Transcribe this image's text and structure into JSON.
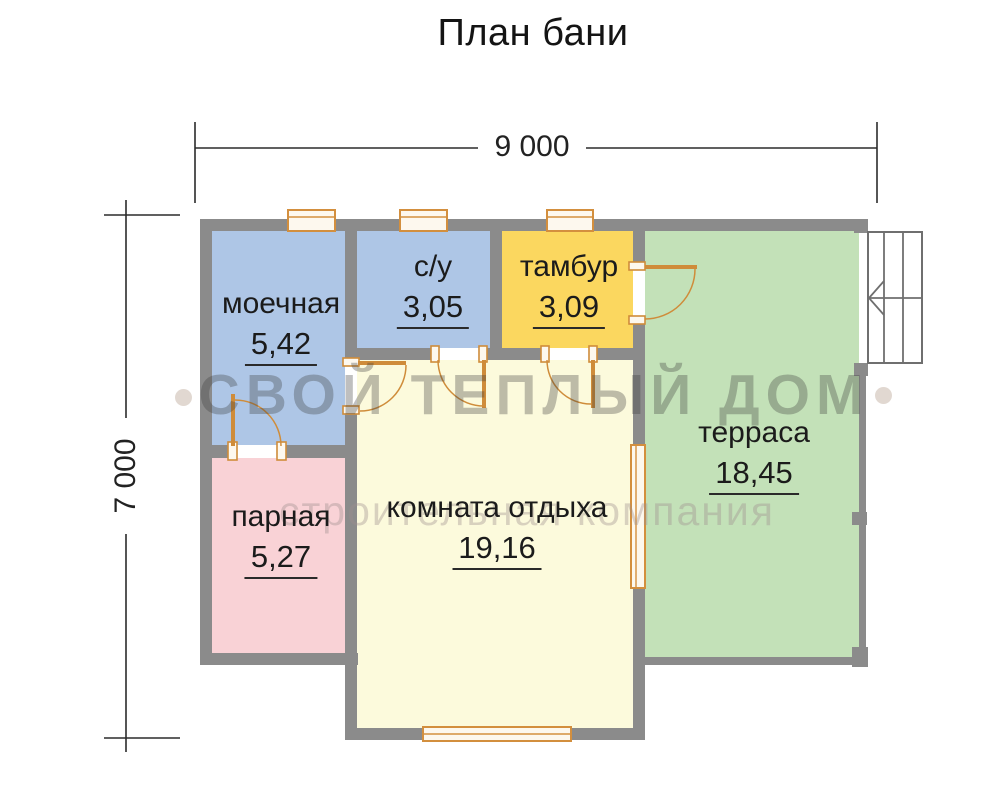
{
  "title": "План бани",
  "dimensions": {
    "width": "9 000",
    "height": "7 000"
  },
  "rooms": [
    {
      "name": "моечная",
      "area": "5,42"
    },
    {
      "name": "с/у",
      "area": "3,05"
    },
    {
      "name": "тамбур",
      "area": "3,09"
    },
    {
      "name": "терраса",
      "area": "18,45"
    },
    {
      "name": "парная",
      "area": "5,27"
    },
    {
      "name": "комната отдыха",
      "area": "19,16"
    }
  ],
  "watermark": {
    "line1": "СВОЙ ТЕПЛЫЙ ДОМ",
    "line2": "строительная компания"
  },
  "colors": {
    "wall": "#8b8b8b",
    "room_wash": "#aec6e6",
    "room_wc": "#aec6e6",
    "room_tambur": "#fbd75f",
    "room_terrace": "#c3e1b8",
    "room_steam": "#f9d2d6",
    "room_lounge": "#fcfadc",
    "door": "#cf8c3a",
    "window_border": "#d38f3e",
    "dimension": "#2b2b2b"
  }
}
